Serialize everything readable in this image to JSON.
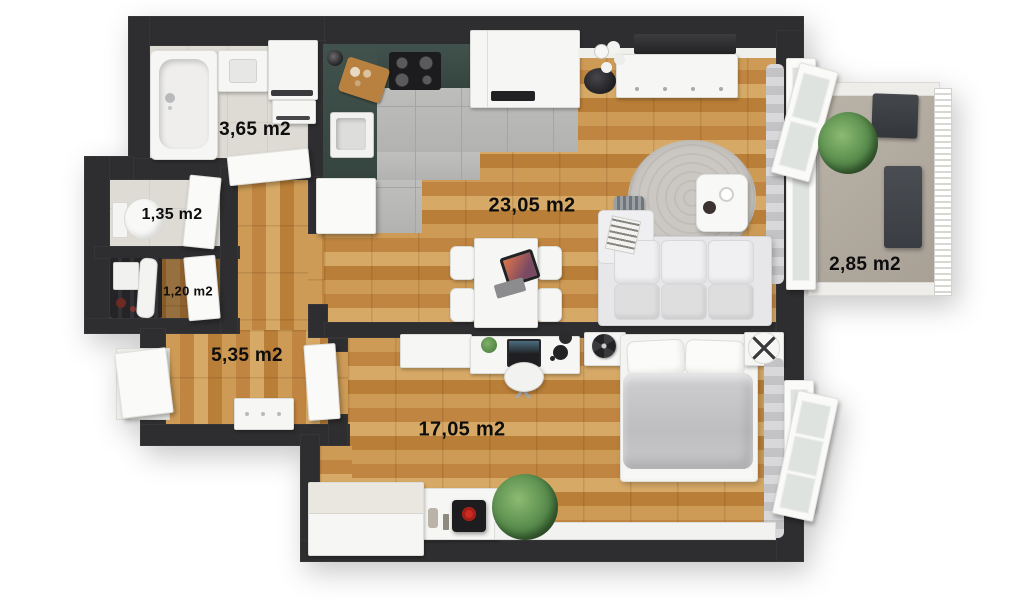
{
  "floorplan": {
    "view": "3d-top-down-apartment-floor-plan",
    "area_unit": "m2",
    "rooms": [
      {
        "id": "bathroom",
        "label": "3,65 m2"
      },
      {
        "id": "wc",
        "label": "1,35 m2"
      },
      {
        "id": "storage",
        "label": "1,20 m2"
      },
      {
        "id": "hallway",
        "label": "5,35 m2"
      },
      {
        "id": "living-room-kitchen",
        "label": "23,05 m2"
      },
      {
        "id": "balcony",
        "label": "2,85 m2"
      },
      {
        "id": "bedroom",
        "label": "17,05 m2"
      }
    ],
    "colors": {
      "wall": "#2e2e30",
      "wood_floor": "#c9914b",
      "tile_floor": "#b8b8b6",
      "bathroom_floor": "#dedad4",
      "balcony_floor": "#b1aaa0",
      "kitchen_counter": "#3b4b46",
      "white_furniture": "#f6f6f4",
      "rug": "#c9c6c1",
      "duvet": "#c6c6c8",
      "record_player_accent": "#cc2a22",
      "plant_green": "#55894a",
      "label_text": "#0d0d0d"
    },
    "furniture": {
      "bathroom": [
        "bathtub",
        "washbasin-cabinet",
        "washing-machine",
        "bathroom-cabinet"
      ],
      "wc": [
        "toilet"
      ],
      "storage": [
        "shelving-unit",
        "storage-box",
        "ironing-board"
      ],
      "hallway": [
        "entry-door",
        "shoe-cabinet"
      ],
      "kitchen": [
        "l-shaped-counter",
        "cooktop",
        "kitchen-sink",
        "cutting-board",
        "moka-pot",
        "tall-cabinet-with-sink"
      ],
      "living_room": [
        "tv",
        "tv-sideboard",
        "floor-lamp",
        "round-rug",
        "coffee-table",
        "sofa-with-chaise",
        "magazine-basket",
        "dining-table",
        "dining-chairs",
        "tablet"
      ],
      "bedroom": [
        "dresser",
        "desk",
        "laptop",
        "desk-lamp",
        "office-chair",
        "nightstand-left",
        "table-fan",
        "double-bed",
        "pillows",
        "duvet",
        "nightstand-right",
        "decor-tray",
        "curtain",
        "wardrobe",
        "display-ledge",
        "vases",
        "record-player",
        "potted-plant"
      ],
      "balcony": [
        "potted-plant",
        "side-table",
        "bistro-table",
        "folding-chairs",
        "railing"
      ]
    }
  }
}
